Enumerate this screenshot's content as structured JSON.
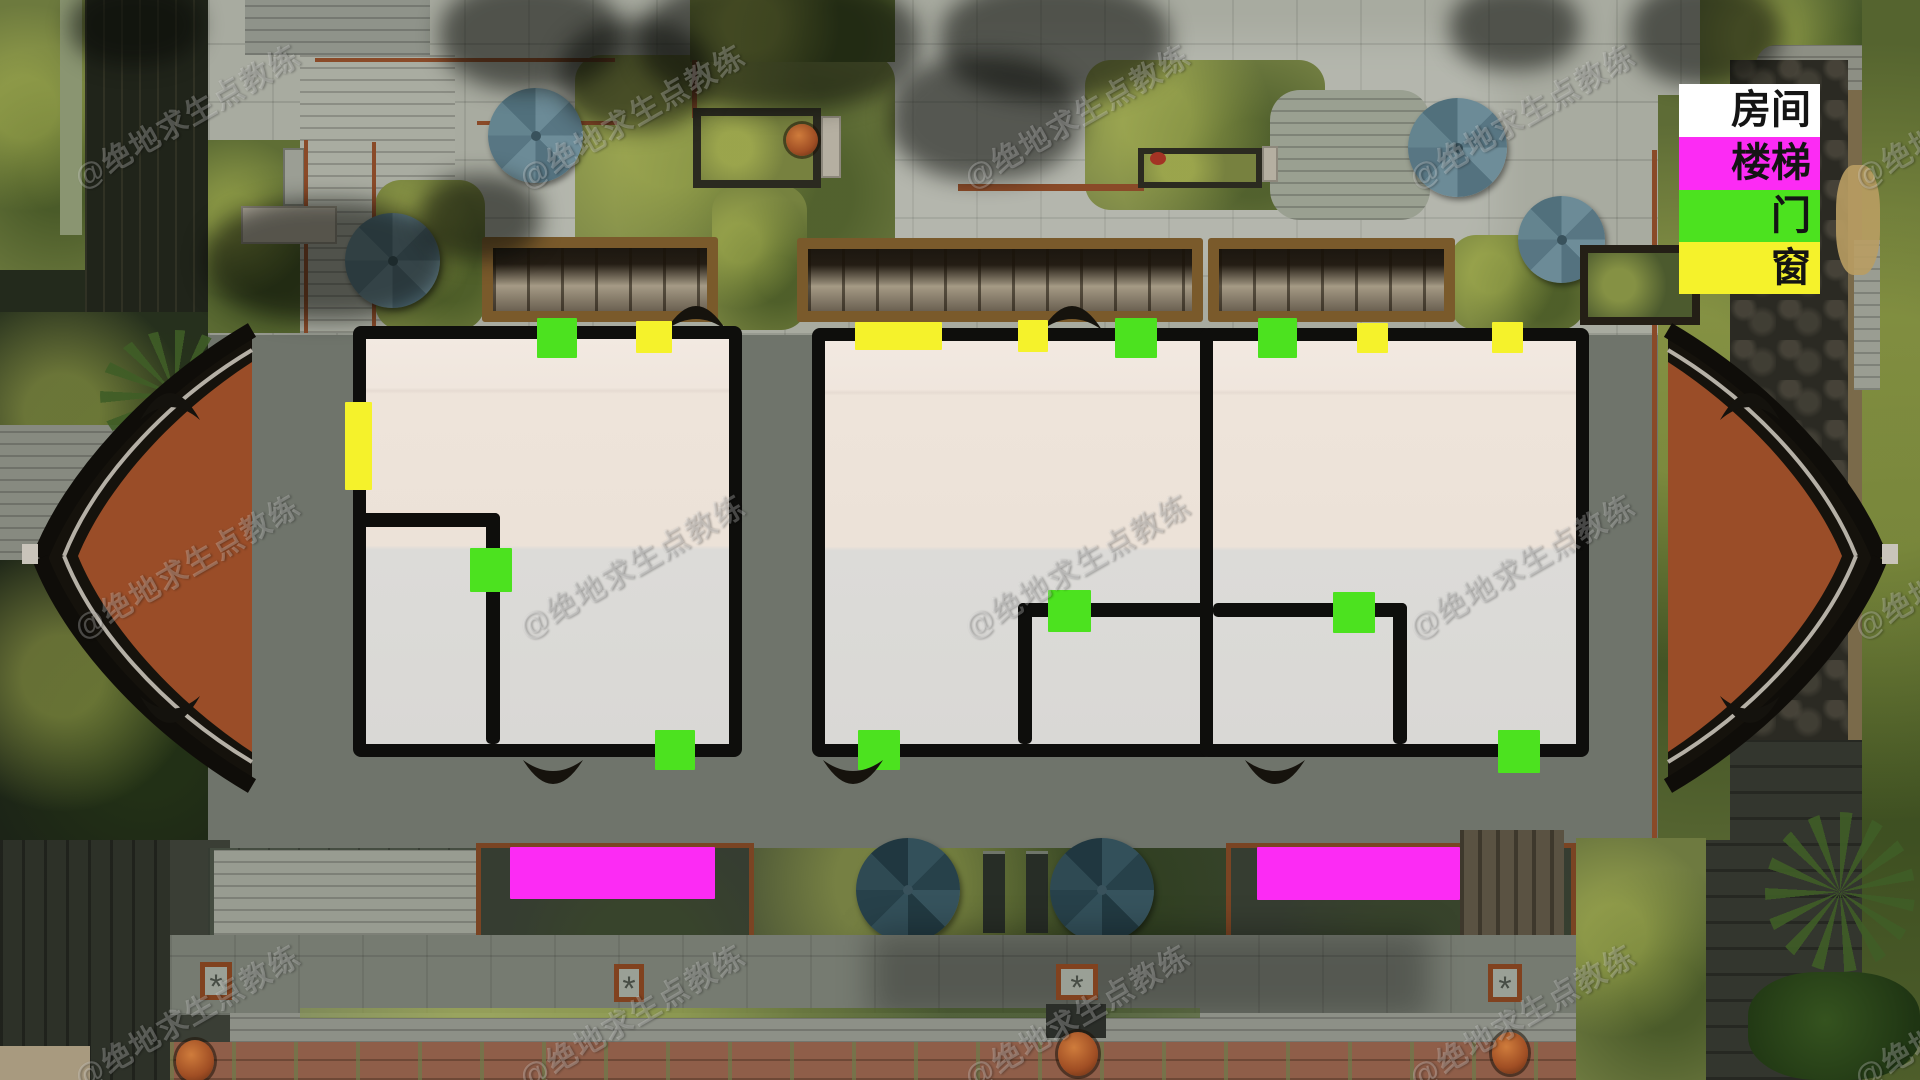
{
  "legend": {
    "items": [
      {
        "id": "room",
        "label": "房间",
        "color": "#ffffff"
      },
      {
        "id": "stairs",
        "label": "楼梯",
        "color": "#fc2bf4"
      },
      {
        "id": "door",
        "label": "门",
        "color": "#4ce21f"
      },
      {
        "id": "window",
        "label": "窗",
        "color": "#f5f22b"
      }
    ]
  },
  "watermark": {
    "text": "@绝地求生点教练",
    "opacity": 0.25,
    "rotation_deg": -30,
    "grid": {
      "cols": [
        100,
        545,
        990,
        1435,
        1880
      ],
      "rows": [
        200,
        650,
        1100
      ]
    }
  },
  "colors": {
    "c-room": "#ffffff",
    "c-stair": "#fc2bf4",
    "c-door": "#4ce21f",
    "c-window": "#f5f22b",
    "c-wall": "#0e0e0c"
  },
  "annotations": {
    "rooms": [
      {
        "id": "left",
        "x": 353,
        "y": 326,
        "w": 389,
        "h": 431,
        "inner_walls": [
          {
            "x": 355,
            "y": 513,
            "w": 145,
            "h": 14
          },
          {
            "x": 486,
            "y": 513,
            "w": 14,
            "h": 231
          }
        ]
      },
      {
        "id": "middle",
        "x": 812,
        "y": 328,
        "w": 401,
        "h": 429,
        "inner_walls": [
          {
            "x": 1018,
            "y": 603,
            "w": 195,
            "h": 14
          },
          {
            "x": 1018,
            "y": 603,
            "w": 14,
            "h": 141
          }
        ]
      },
      {
        "id": "right",
        "x": 1200,
        "y": 328,
        "w": 389,
        "h": 429,
        "inner_walls": [
          {
            "x": 1213,
            "y": 603,
            "w": 194,
            "h": 14
          },
          {
            "x": 1393,
            "y": 603,
            "w": 14,
            "h": 141
          }
        ]
      }
    ],
    "doors": [
      {
        "x": 537,
        "y": 318,
        "w": 40,
        "h": 40
      },
      {
        "x": 470,
        "y": 548,
        "w": 42,
        "h": 44
      },
      {
        "x": 655,
        "y": 730,
        "w": 40,
        "h": 40
      },
      {
        "x": 1115,
        "y": 318,
        "w": 42,
        "h": 40
      },
      {
        "x": 1048,
        "y": 590,
        "w": 43,
        "h": 42
      },
      {
        "x": 858,
        "y": 730,
        "w": 42,
        "h": 40
      },
      {
        "x": 1258,
        "y": 318,
        "w": 39,
        "h": 40
      },
      {
        "x": 1333,
        "y": 592,
        "w": 42,
        "h": 41
      },
      {
        "x": 1498,
        "y": 730,
        "w": 42,
        "h": 43
      }
    ],
    "windows": [
      {
        "x": 636,
        "y": 321,
        "w": 36,
        "h": 32
      },
      {
        "x": 345,
        "y": 402,
        "w": 27,
        "h": 88
      },
      {
        "x": 855,
        "y": 322,
        "w": 87,
        "h": 28
      },
      {
        "x": 1018,
        "y": 320,
        "w": 30,
        "h": 32
      },
      {
        "x": 1357,
        "y": 323,
        "w": 31,
        "h": 30
      },
      {
        "x": 1492,
        "y": 322,
        "w": 31,
        "h": 31
      }
    ],
    "stairs": [
      {
        "x": 510,
        "y": 847,
        "w": 205,
        "h": 52
      },
      {
        "x": 1257,
        "y": 847,
        "w": 203,
        "h": 53
      }
    ]
  }
}
